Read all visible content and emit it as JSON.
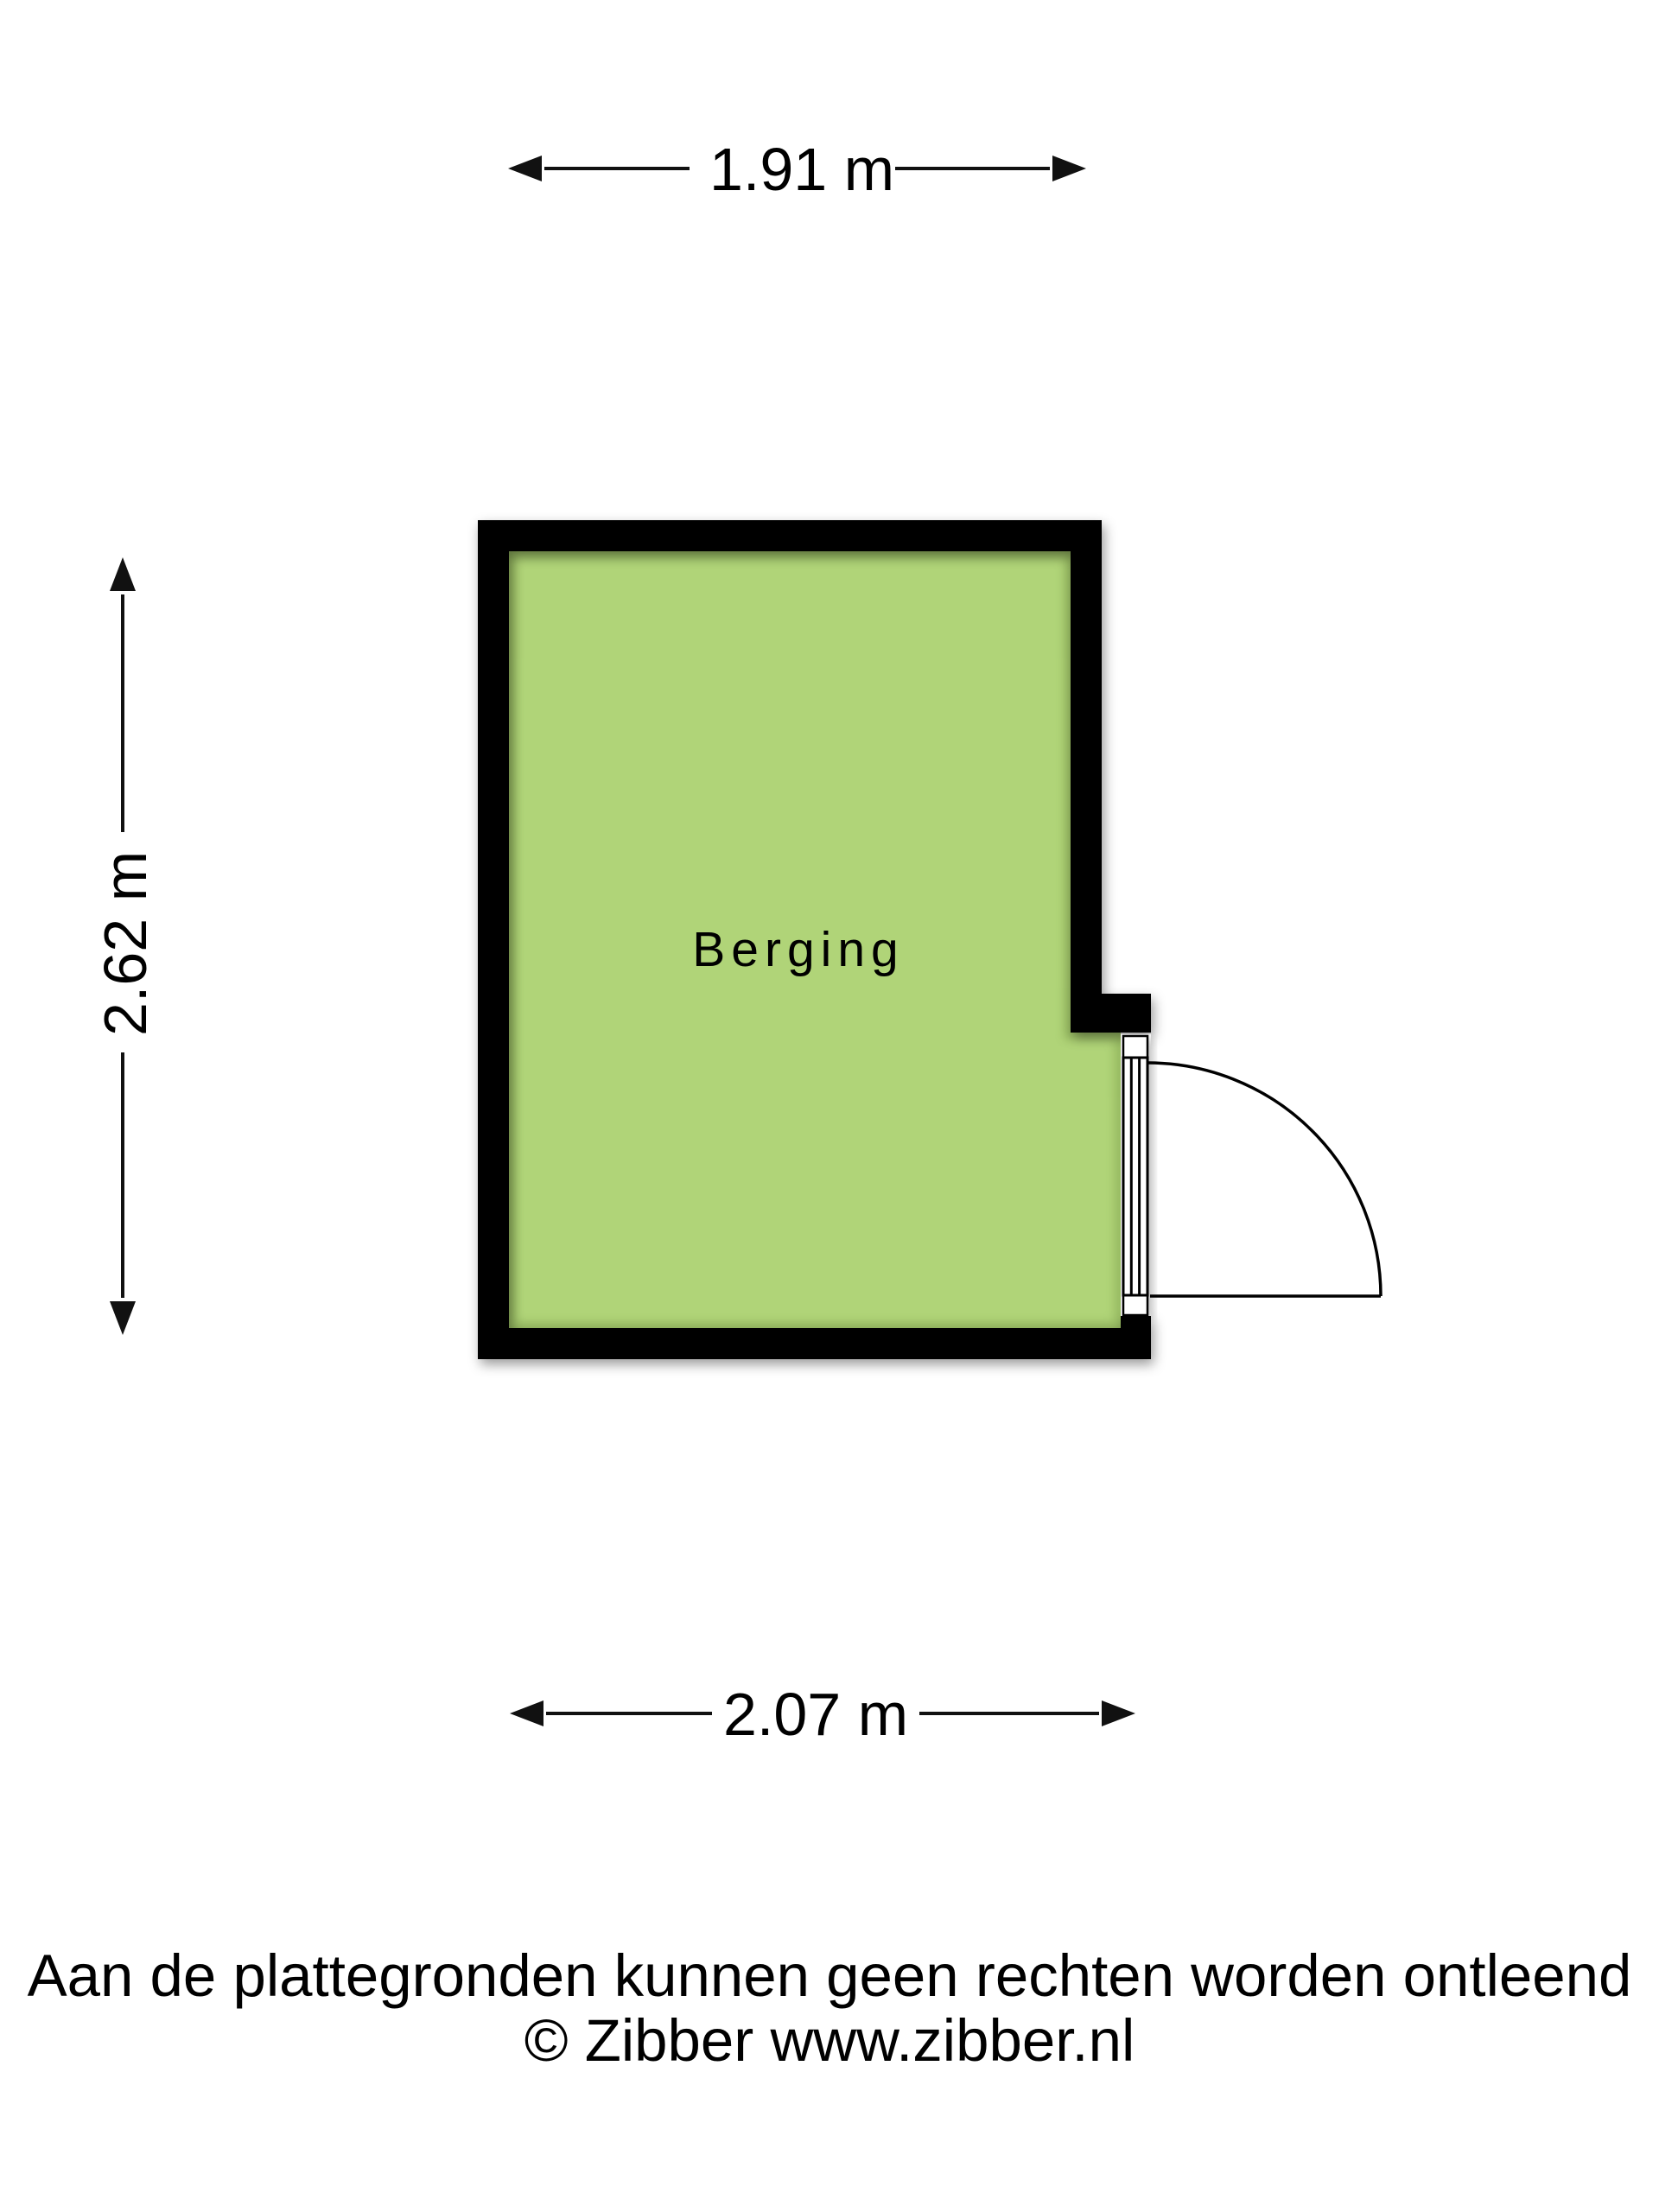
{
  "floorplan": {
    "room_label": "Berging",
    "dim_top": "1.91 m",
    "dim_left": "2.62 m",
    "dim_bottom": "2.07 m"
  },
  "footer": {
    "disclaimer": "Aan de plattegronden kunnen geen rechten worden ontleend",
    "copyright": "© Zibber www.zibber.nl"
  },
  "colors": {
    "background": "#ffffff",
    "wall": "#000000",
    "room_fill": "#b0d478",
    "room_shade": "#7fa24c",
    "line": "#111111"
  }
}
